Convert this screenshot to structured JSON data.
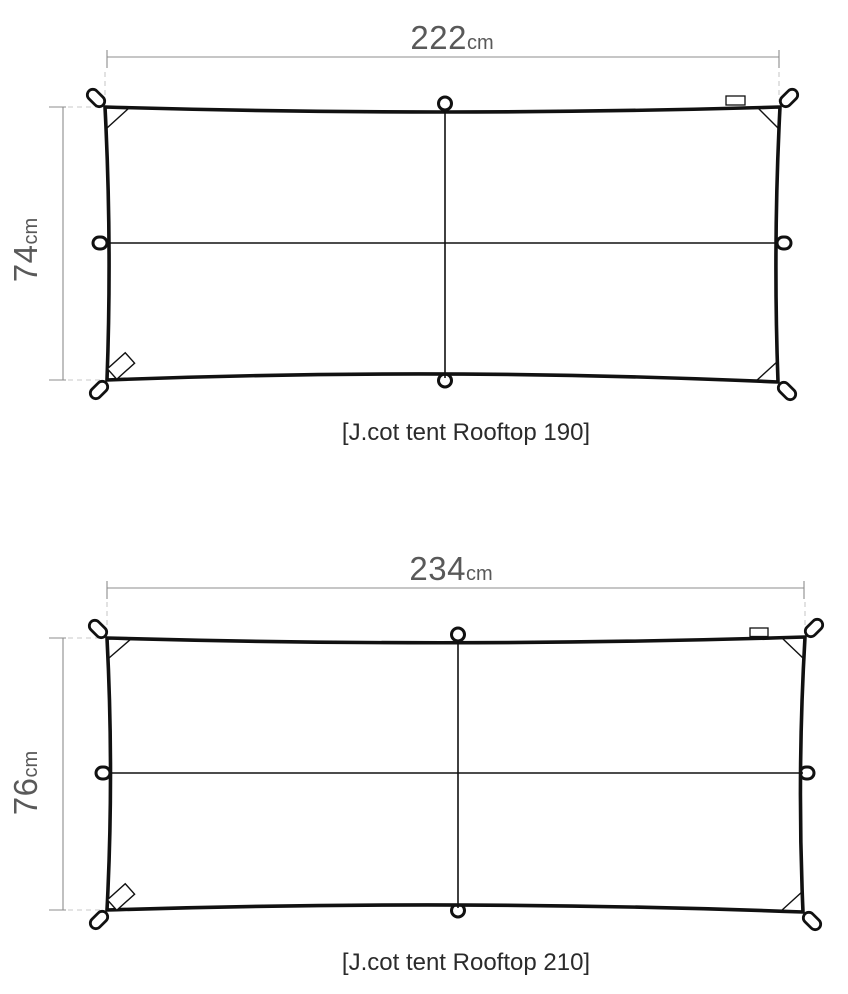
{
  "colors": {
    "line": "#111111",
    "dimension_line": "#8c8c8c",
    "extension_line": "#c9c9c9",
    "dimension_text": "#595959",
    "caption_text": "#2b2b2b",
    "background": "#ffffff"
  },
  "diagrams": [
    {
      "caption": "[J.cot tent Rooftop 190]",
      "width_value": "222",
      "width_unit": "cm",
      "height_value": "74",
      "height_unit": "cm"
    },
    {
      "caption": "[J.cot tent Rooftop 210]",
      "width_value": "234",
      "width_unit": "cm",
      "height_value": "76",
      "height_unit": "cm"
    }
  ]
}
